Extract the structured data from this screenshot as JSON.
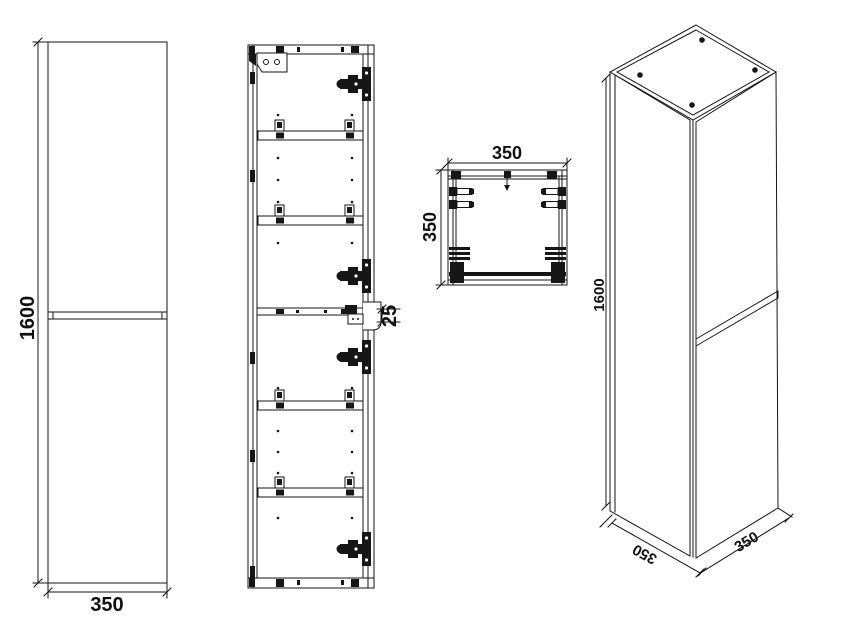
{
  "views": {
    "front_elevation": {
      "height": "1600",
      "width": "350"
    },
    "internal_front": {
      "door_gap": "25"
    },
    "top_view": {
      "width": "350",
      "depth": "350"
    },
    "isometric": {
      "height": "1600",
      "depth": "350",
      "width": "350"
    }
  },
  "colors": {
    "line": "#161616",
    "background": "#ffffff"
  }
}
